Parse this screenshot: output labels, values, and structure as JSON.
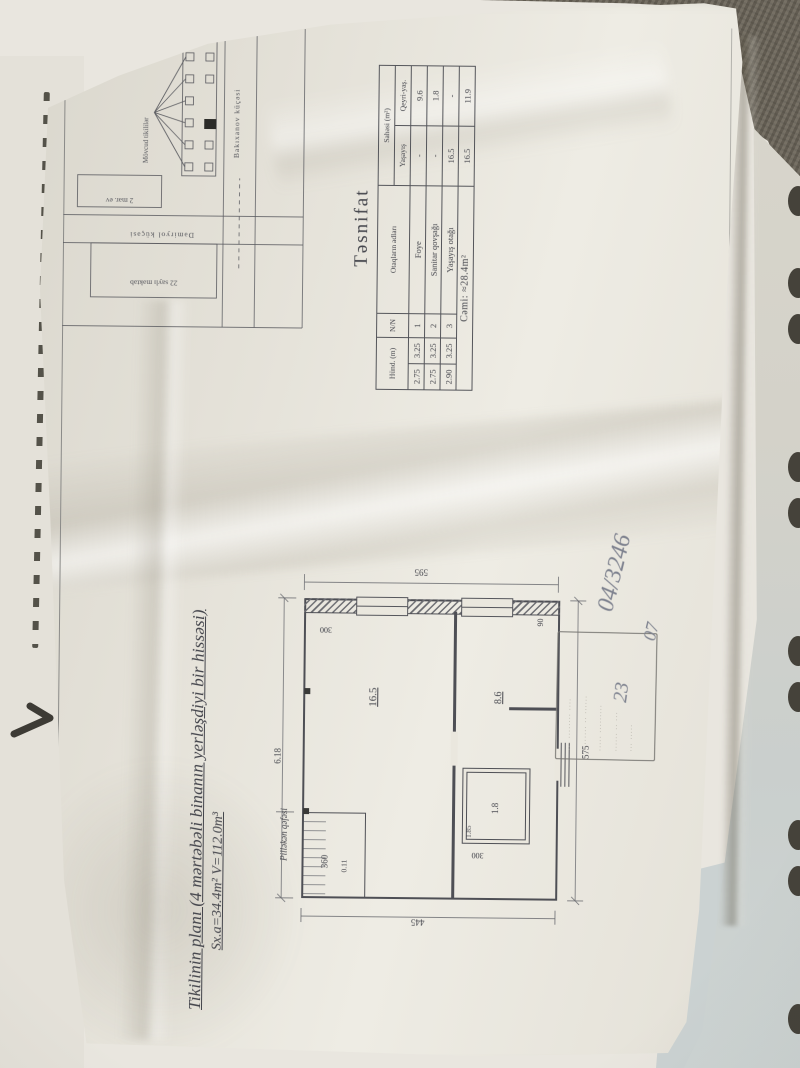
{
  "document": {
    "title_line1": "Tikilinin planı (4 mərtəbəli binanın yerləşdiyi bir hissəsi)",
    "title_line2": "Sx.a=34.4m²   V=112.0m³"
  },
  "site_plan": {
    "legend_label": "Mövcud tikililər",
    "street_horizontal": "Bakıxanov küçəsi",
    "street_vertical": "Dəmiryol küçəsi",
    "box_small_label": "2 mər. ev",
    "box_large_label": "22 saylı məktəb"
  },
  "classification_table": {
    "heading": "Təsnifat",
    "columns": {
      "height": "Hünd. (m)",
      "nn": "N/N",
      "rooms": "Otaqların adları",
      "area_group": "Sahəsi (m²)",
      "area_res": "Yaşayış",
      "area_nonres": "Qeyri-yaş."
    },
    "rows": [
      {
        "h1": "2.75",
        "h2": "3.25",
        "n": "1",
        "room": "Foye",
        "a_res": "-",
        "a_non": "9.6"
      },
      {
        "h1": "2.75",
        "h2": "3.25",
        "n": "2",
        "room": "Sanitar qovşağı",
        "a_res": "-",
        "a_non": "1.8"
      },
      {
        "h1": "2.90",
        "h2": "3.25",
        "n": "3",
        "room": "Yaşayış otağı",
        "a_res": "16.5",
        "a_non": "-"
      }
    ],
    "total_label": "Cəmi: ≈28.4m²",
    "total_res": "16.5",
    "total_non": "11.9"
  },
  "floor_plan": {
    "stair_label": "Pilləkən qəfəsi",
    "room_living": "16.5",
    "room_hall": "8.6",
    "room_bath": "1.8",
    "bath_width": "1.85",
    "dim_top": "6.18",
    "dim_right": "595",
    "dim_bottom": "575",
    "dim_left": "445",
    "dim_stair": "360",
    "dim_wall": "0.11",
    "dim_window": "300",
    "dim_door": "300",
    "dim_pier": "90"
  },
  "stamp": {
    "lines": [
      "··· ········ ····",
      "········ ·· ······",
      "····· ·········",
      "······ ·· ···",
      "··· ·····"
    ]
  },
  "handwriting": {
    "note_main": "04/3246",
    "note_sub": "07",
    "note_page": "23"
  },
  "colors": {
    "paper": "#e8e5dc",
    "ink": "#4a4b52",
    "pencil": "#7d818e",
    "backdrop_dark": "#6d675b",
    "binder_hole": "#45423a"
  }
}
